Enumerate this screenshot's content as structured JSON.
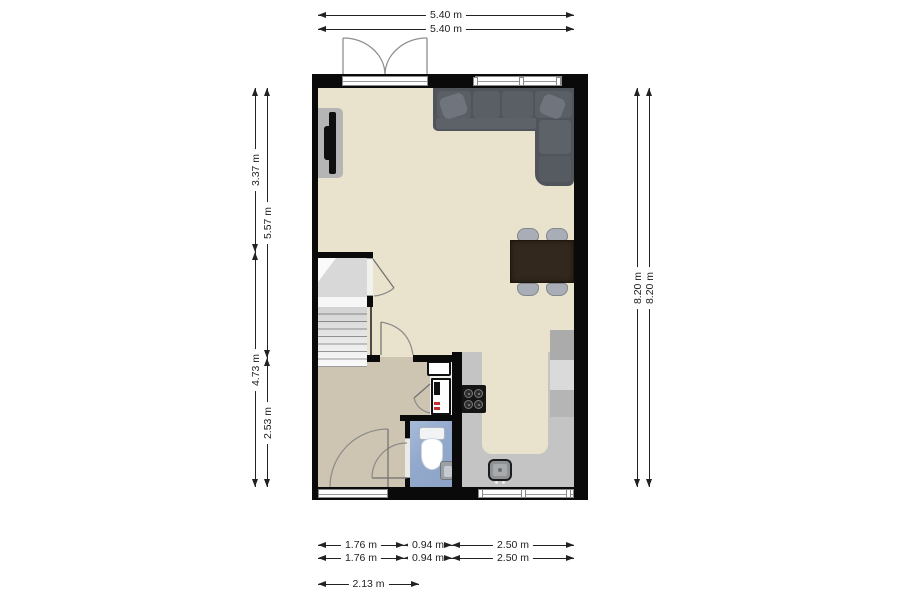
{
  "plan": {
    "type": "floor-plan",
    "dims": {
      "top": [
        "5.40 m",
        "5.40 m"
      ],
      "left_outer": [
        "3.37 m",
        "4.73 m"
      ],
      "left_inner": [
        "5.57 m",
        "2.53 m"
      ],
      "right": [
        "8.20 m",
        "8.20 m"
      ],
      "bottom_row1": [
        "1.76 m",
        "0.94 m",
        "2.50 m"
      ],
      "bottom_row2": [
        "1.76 m",
        "0.94 m",
        "2.50 m"
      ],
      "bottom_row3": [
        "2.13 m"
      ]
    },
    "colors": {
      "wall": "#0a0a0a",
      "floor_main": "#e9e3cd",
      "floor_hall": "#cec4b2",
      "floor_toilet": "#93a9cc",
      "kitchen_counter": "#c4c4c4",
      "cabinet_light": "#dadada",
      "cabinet_dark": "#ababab",
      "sofa": "#50545b",
      "table_wood": "#33281d",
      "chair": "#a9aeb6",
      "stove": "#151515",
      "boiler_accent": "#c03030",
      "dimension_text": "#1d1d1d"
    }
  }
}
